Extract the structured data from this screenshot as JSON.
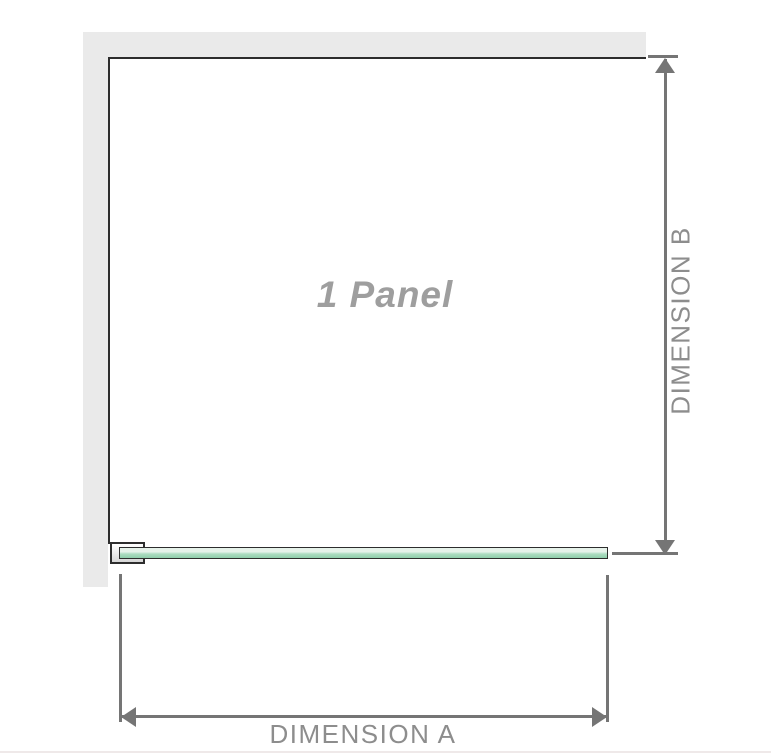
{
  "diagram": {
    "panel_label": "1 Panel",
    "dimension_a": {
      "label": "DIMENSION A"
    },
    "dimension_b": {
      "label": "DIMENSION B"
    }
  },
  "colors": {
    "wall": "#eaeaea",
    "outline": "#2d2d2d",
    "dimension_line": "#757575",
    "dimension_text": "#8d8d8d",
    "panel_label_text": "#9e9e9e",
    "glass_top": "#e6f2ea",
    "glass_mid": "#abdcc0",
    "glass_bottom": "#8fceac",
    "bracket_fill_top": "#ffffff",
    "bracket_fill_bottom": "#d6d6d6",
    "page_edge": "#efe9e9"
  }
}
